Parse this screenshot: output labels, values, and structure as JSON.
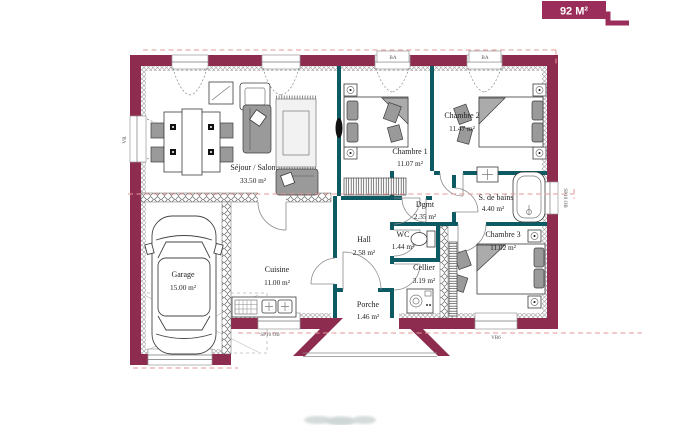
{
  "badge": {
    "label": "92 M²"
  },
  "colors": {
    "wall": "#8e2c50",
    "partition": "#0e5a63",
    "badge": "#9b2d5b",
    "dashes": "#e59a9a"
  },
  "rooms": {
    "sejour": {
      "name": "Séjour / Salon",
      "area": "33.50 m²"
    },
    "chambre1": {
      "name": "Chambre 1",
      "area": "11.07 m²"
    },
    "chambre2": {
      "name": "Chambre 2",
      "area": "11.47 m²"
    },
    "chambre3": {
      "name": "Chambre 3",
      "area": "11.02 m²"
    },
    "sdb": {
      "name": "S. de bains",
      "area": "4.40 m²"
    },
    "dgmt": {
      "name": "Dgmt",
      "area": "2.35 m²"
    },
    "wc": {
      "name": "WC",
      "area": "1.44 m²"
    },
    "hall": {
      "name": "Hall",
      "area": "2.58 m²"
    },
    "cellier": {
      "name": "Cellier",
      "area": "3.19 m²"
    },
    "cuisine": {
      "name": "Cuisine",
      "area": "11.00 m²"
    },
    "garage": {
      "name": "Garage",
      "area": "15.00 m²"
    },
    "porche": {
      "name": "Porche",
      "area": "1.46 m²"
    }
  },
  "codes": {
    "window_ch1": "BA",
    "window_ch2": "BA",
    "window_cuisine": "SP10 OB",
    "window_sdb": "SP10 OB",
    "window_ch3": "VR6",
    "window_sejour_left": "VR"
  }
}
